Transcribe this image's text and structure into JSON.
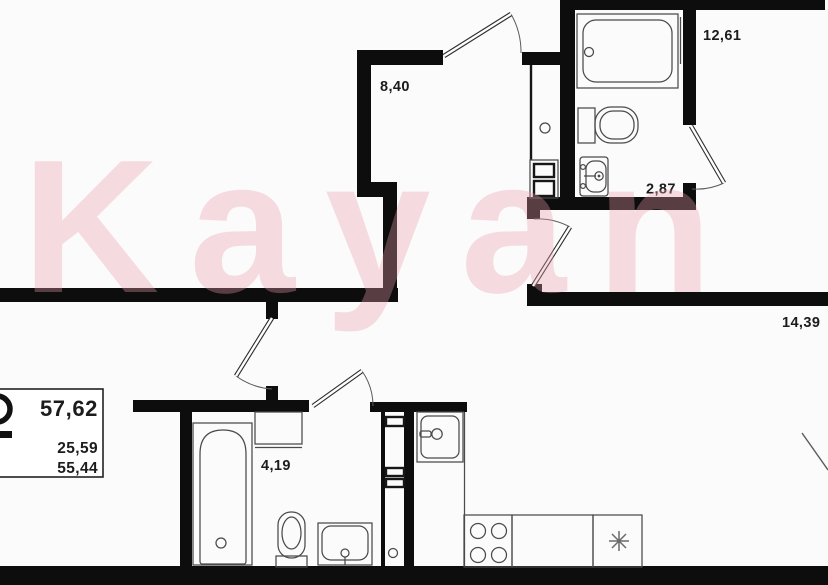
{
  "watermark": {
    "text": "Kayan",
    "color": "#e89eac",
    "opacity": 0.34
  },
  "rooms": {
    "hallway": {
      "name": "hallway",
      "label": "8,40"
    },
    "bedroom": {
      "name": "bedroom",
      "label": "12,61"
    },
    "bathroom_top": {
      "name": "bathroom",
      "label": "2,87"
    },
    "kitchen_living": {
      "name": "kitchen-living",
      "label": "14,39"
    },
    "bathroom_bottom": {
      "name": "second-bathroom",
      "label": "4,19"
    }
  },
  "stats": {
    "total_area": "57,62",
    "area_mid": "25,59",
    "area_bottom": "55,44"
  },
  "colors": {
    "wall": "#0d0d0d",
    "fixture_line": "#4a4a4a",
    "background": "#fcfbfb",
    "watermark_pink": "#e89eac"
  },
  "fixtures": [
    "bathtub-top",
    "toilet-top",
    "washbasin-top",
    "ventilation-shaft-top",
    "bathtub-bottom",
    "toilet-bottom",
    "washbasin-bottom",
    "washing-machine",
    "ventilation-shaft-bottom",
    "kitchen-sink-unit",
    "stove-burners",
    "kitchen-counter",
    "fridge-snowflake"
  ]
}
